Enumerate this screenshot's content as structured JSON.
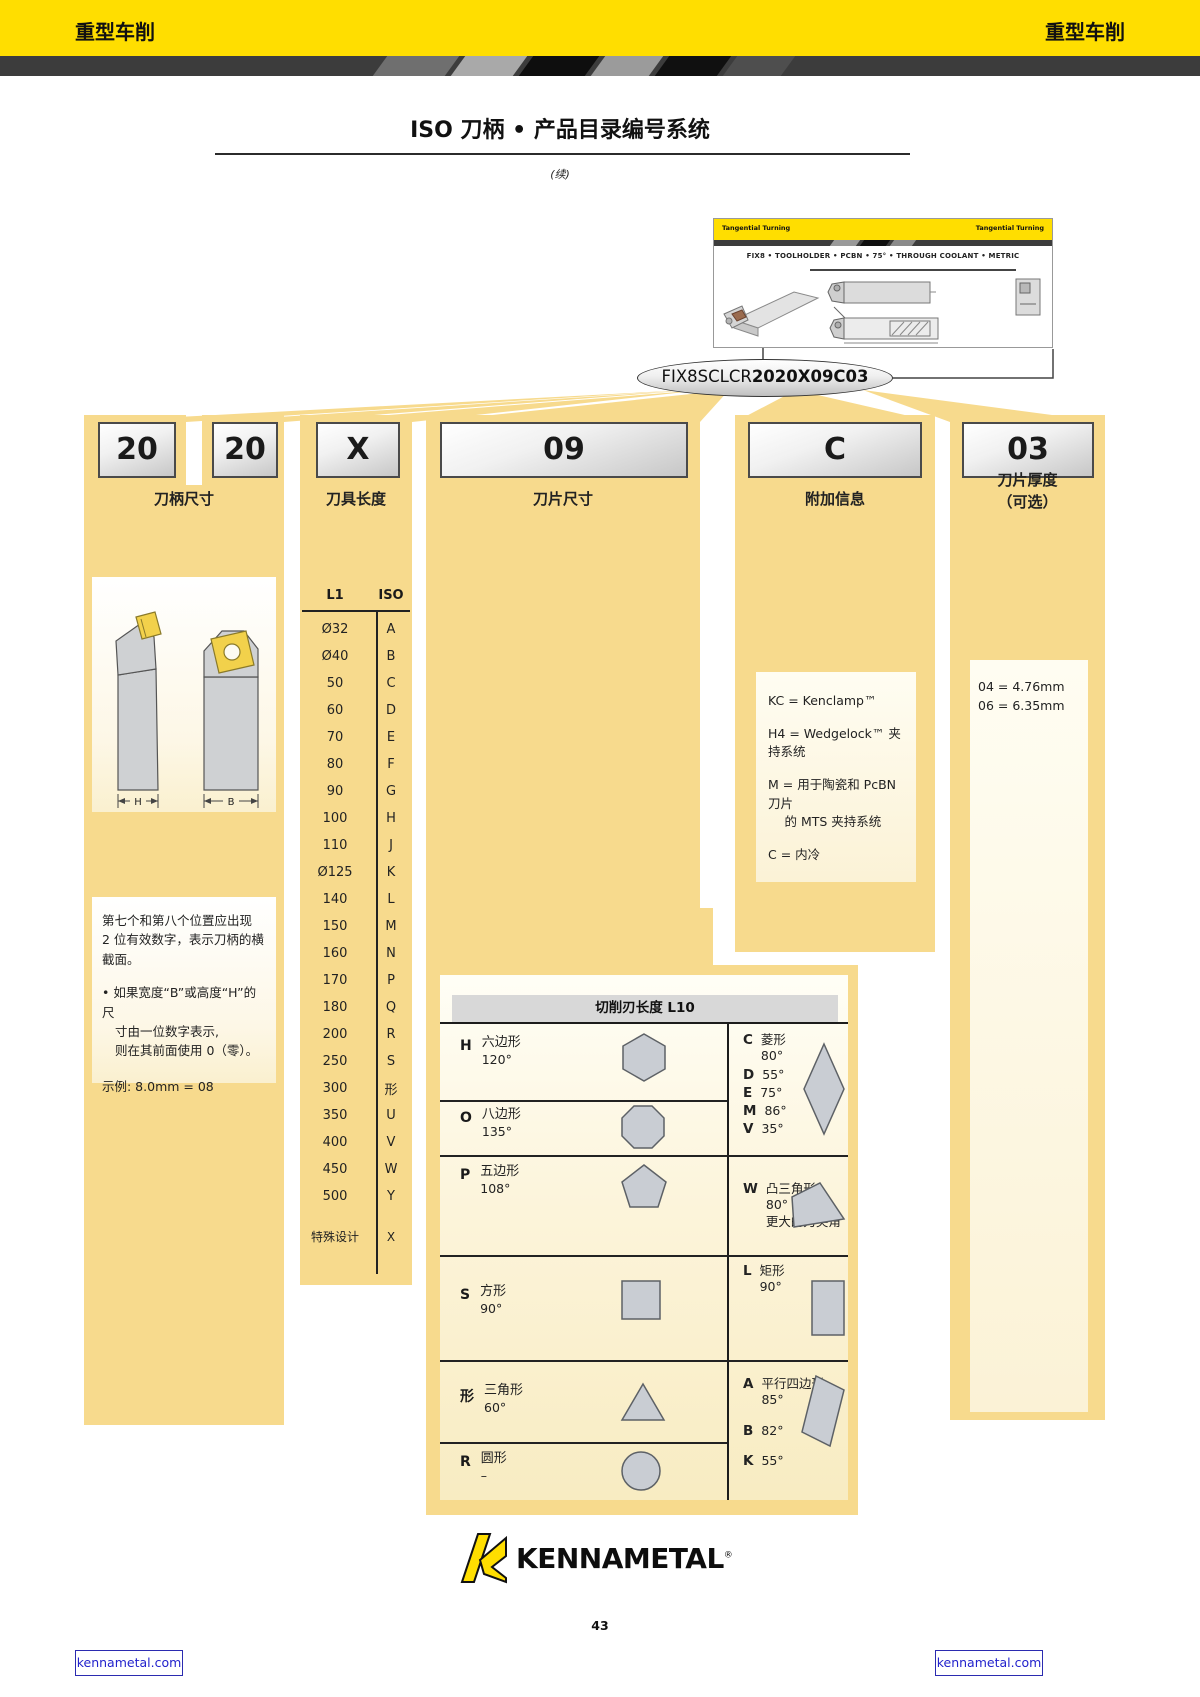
{
  "band": {
    "left": "重型车削",
    "right": "重型车削"
  },
  "title": {
    "text": "ISO 刀柄 • 产品目录编号系统",
    "continued": "(续)"
  },
  "card": {
    "tab_left": "Tangential Turning",
    "tab_right": "Tangential Turning",
    "line": "FIX8 • TOOLHOLDER • PCBN • 75° • THROUGH COOLANT • METRIC"
  },
  "part_number": {
    "normal": "FIX8SCLCR",
    "bold": "2020X09C03"
  },
  "positions": {
    "shank": {
      "codes": [
        "20",
        "20"
      ],
      "label": "刀柄尺寸",
      "dim_labels": [
        "H",
        "B"
      ],
      "note_lines": [
        "第七个和第八个位置应出现",
        "2 位有效数字，表示刀柄的横",
        "截面。"
      ],
      "bullet_lines": [
        "• 如果宽度“B”或高度“H”的尺",
        "寸由一位数字表示,",
        "则在其前面使用 0（零）。"
      ],
      "example": "示例:  8.0mm = 08"
    },
    "length": {
      "code": "X",
      "label": "刀具长度",
      "table": {
        "col1": "L1",
        "col2": "ISO",
        "rows": [
          [
            "Ø32",
            "A"
          ],
          [
            "Ø40",
            "B"
          ],
          [
            "50",
            "C"
          ],
          [
            "60",
            "D"
          ],
          [
            "70",
            "E"
          ],
          [
            "80",
            "F"
          ],
          [
            "90",
            "G"
          ],
          [
            "100",
            "H"
          ],
          [
            "110",
            "J"
          ],
          [
            "Ø125",
            "K"
          ],
          [
            "140",
            "L"
          ],
          [
            "150",
            "M"
          ],
          [
            "160",
            "N"
          ],
          [
            "170",
            "P"
          ],
          [
            "180",
            "Q"
          ],
          [
            "200",
            "R"
          ],
          [
            "250",
            "S"
          ],
          [
            "300",
            "形"
          ],
          [
            "350",
            "U"
          ],
          [
            "400",
            "V"
          ],
          [
            "450",
            "W"
          ],
          [
            "500",
            "Y"
          ]
        ],
        "special": [
          "特殊设计",
          "X"
        ]
      }
    },
    "insert_size": {
      "code": "09",
      "label": "刀片尺寸",
      "table_title": "切削刃长度 L10",
      "left_rows": [
        {
          "letter": "H",
          "name": "六边形",
          "angle": "120°",
          "shape": "hexagon"
        },
        {
          "letter": "O",
          "name": "八边形",
          "angle": "135°",
          "shape": "octagon"
        },
        {
          "letter": "P",
          "name": "五边形",
          "angle": "108°",
          "shape": "pentagon"
        },
        {
          "letter": "S",
          "name": "方形",
          "angle": "90°",
          "shape": "square"
        },
        {
          "letter": "形",
          "name": "三角形",
          "angle": "60°",
          "shape": "triangle"
        },
        {
          "letter": "R",
          "name": "圆形",
          "angle": "–",
          "shape": "circle"
        }
      ],
      "right_rows": [
        {
          "shape": "diamond",
          "lines": [
            [
              "C",
              "菱形",
              "80°",
              ""
            ],
            [
              "D",
              "",
              "55°",
              ""
            ],
            [
              "E",
              "",
              "75°",
              ""
            ],
            [
              "M",
              "",
              "86°",
              ""
            ],
            [
              "V",
              "",
              "35°",
              ""
            ]
          ]
        },
        {
          "shape": "trigon",
          "lines": [
            [
              "W",
              "凸三角形",
              "80°",
              "更大的刀尖角"
            ]
          ]
        },
        {
          "shape": "rectangle",
          "lines": [
            [
              "L",
              "矩形",
              "90°",
              ""
            ]
          ]
        },
        {
          "shape": "parallelogram",
          "lines": [
            [
              "A",
              "平行四边形",
              "85°",
              ""
            ],
            [
              "B",
              "",
              "82°",
              ""
            ],
            [
              "K",
              "",
              "55°",
              ""
            ]
          ]
        }
      ]
    },
    "extra": {
      "code": "C",
      "label": "附加信息",
      "notes": [
        "KC = Kenclamp™",
        "H4 = Wedgelock™ 夹持系统",
        "M = 用于陶瓷和 PcBN 刀片\n　 的 MTS 夹持系统",
        "C = 内冷"
      ]
    },
    "thickness": {
      "code": "03",
      "label_line1": "刀片厚度",
      "label_line2": "（可选）",
      "options": [
        "04 = 4.76mm",
        "06 = 6.35mm"
      ]
    }
  },
  "footer": {
    "brand": "KENNAMETAL",
    "reg": "®",
    "page_number": "43",
    "link_left": "kennametal.com",
    "link_right": "kennametal.com"
  },
  "colors": {
    "brand_yellow": "#FFDE00",
    "panel_yellow": "#F7DA8D",
    "link_blue": "#2222CC"
  }
}
